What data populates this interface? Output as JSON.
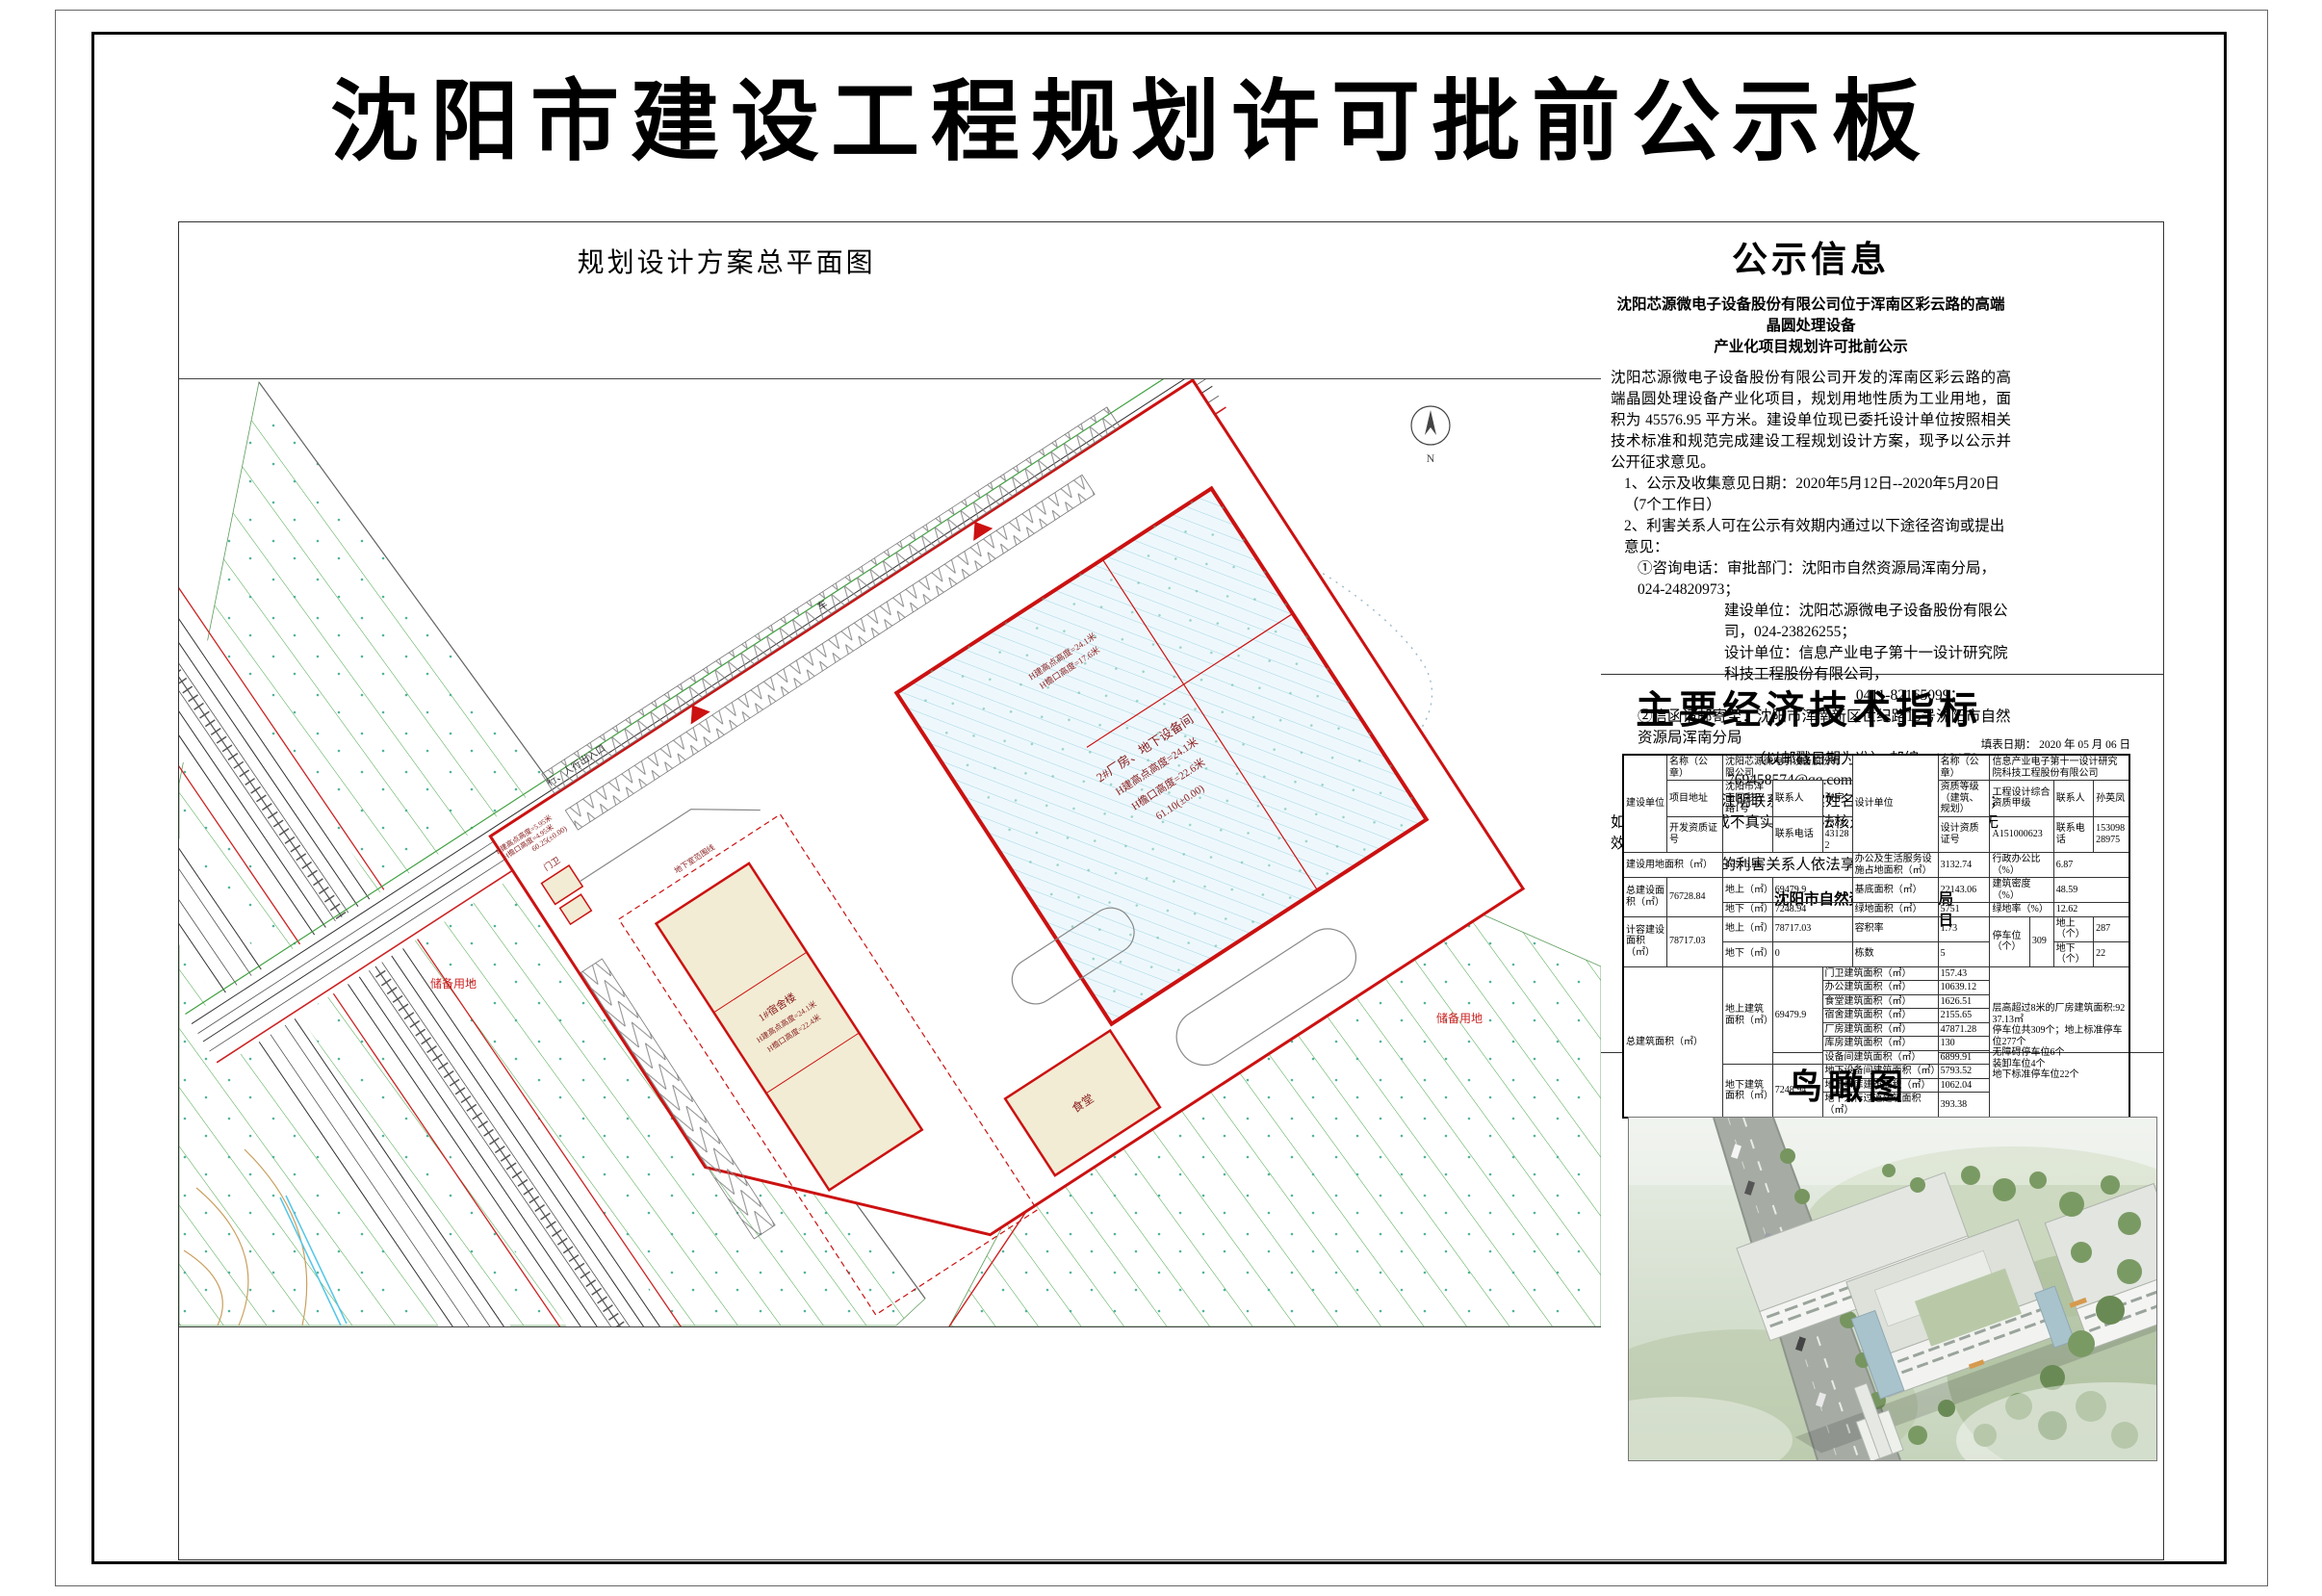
{
  "page": {
    "title": "沈阳市建设工程规划许可批前公示板"
  },
  "plan": {
    "title": "规划设计方案总平面图",
    "labels": {
      "reserve1": "储备用地",
      "reserve2": "储备用地",
      "factory_name": "2#厂房、地下设备间",
      "factory_h1": "H建高点高度=24.1米",
      "factory_h2": "H檐口高度=22.6米",
      "factory_elev": "61.10(±0.00)",
      "factory_h3": "H建高点高度=24.1米",
      "factory_h4": "H檐口高度=17.6米",
      "dorm_name": "1#宿舍楼",
      "dorm_h1": "H建高点高度=24.1米",
      "dorm_h2": "H檐口高度=22.4米",
      "canteen": "食堂",
      "gate": "门卫",
      "entrance": "车行、人行出入口",
      "basement": "地下室范围线",
      "gate_h1": "H建高点高度=5.95米",
      "gate_h2": "H檐口高度=4.95米",
      "gate_elev": "60.25(±0.00)",
      "north": "N"
    }
  },
  "notice": {
    "title": "公示信息",
    "subtitle": "沈阳芯源微电子设备股份有限公司位于浑南区彩云路的高端晶圆处理设备\n产业化项目规划许可批前公示",
    "para": "沈阳芯源微电子设备股份有限公司开发的浑南区彩云路的高端晶圆处理设备产业化项目，规划用地性质为工业用地，面积为 45576.95 平方米。建设单位现已委托设计单位按照相关技术标准和规范完成建设工程规划设计方案，现予以公示并公开征求意见。",
    "lines": [
      "1、公示及收集意见日期：2020年5月12日--2020年5月20日（7个工作日）",
      "2、利害关系人可在公示有效期内通过以下途径咨询或提出意见：",
      "①咨询电话：审批部门：沈阳市自然资源局浑南分局，024-24820973；",
      "建设单位：沈阳芯源微电子设备股份有限公司，024-23826255；",
      "设计单位：信息产业电子第十一设计研究院科技工程股份有限公司，",
      "0411-82165099；",
      "②信函请邮寄至：沈阳市浑南新区世纪路15号沈阳市自然资源局浑南分局",
      "（以邮戳日期为准）  邮编：110179。",
      "③电子邮箱：769458574@qq.com 。",
      "3、反馈意见请注明联系人真实姓名、电话、地址等信息；如因信息不完整或不真实导致无法核对相关情况的，视为无效意见。",
      "4、本方案涉及的利害关系人依法享有听证权。"
    ],
    "sign1": "沈阳市自然资源局浑南分局",
    "sign2": "2020年5月12日"
  },
  "indicators": {
    "title": "主要经济技术指标",
    "fill_date": "填表日期：  2020 年 05 月 06 日",
    "owner_group": "建设单位",
    "owner_name_label": "名称（公章）",
    "owner_name": "沈阳芯源微电子设备股份有限公司",
    "owner_addr_label": "项目地址",
    "owner_addr": "沈阳市浑南区彩云路1号",
    "owner_contact_label": "联系人",
    "owner_contact": "张宇",
    "owner_cert_label": "开发资质证号",
    "owner_cert": "",
    "owner_phone_label": "联系电话",
    "owner_phone": "13332431282",
    "designer_group": "设计单位",
    "designer_name_label": "名称（公章）",
    "designer_name": "信息产业电子第十一设计研究院科技工程股份有限公司",
    "designer_grade_label": "资质等级（建筑、规划）",
    "designer_grade": "工程设计综合资质甲级",
    "designer_contact_label": "联系人",
    "designer_contact": "孙英凤",
    "designer_cert_label": "设计资质证号",
    "designer_cert": "A151000623",
    "designer_phone_label": "联系电话",
    "designer_phone": "15309828975",
    "land_label": "建设用地面积（㎡）",
    "land": "45576.95",
    "office_land_label": "办公及生活服务设施占地面积（㎡）",
    "office_land": "3132.74",
    "admin_ratio_label": "行政办公比（%）",
    "admin_ratio": "6.87",
    "total_label": "总建设面积（㎡）",
    "total": "76728.84",
    "above_label": "地上（㎡）",
    "above": "69479.9",
    "below_label": "地下（㎡）",
    "below": "7248.94",
    "base_label": "基底面积（㎡）",
    "base": "22143.06",
    "density_label": "建筑密度（%）",
    "density": "48.59",
    "green_label": "绿地面积（㎡）",
    "green": "5751",
    "green_rate_label": "绿地率（%）",
    "green_rate": "12.62",
    "cap_label": "计容建设面积（㎡）",
    "cap": "78717.03",
    "cap_above_label": "地上（㎡）",
    "cap_above": "78717.03",
    "cap_below_label": "地下（㎡）",
    "cap_below": "0",
    "far_label": "容积率",
    "far": "1.73",
    "blocks_label": "栋数",
    "blocks": "5",
    "park_label": "停车位（个）",
    "park": "309",
    "park_above_label": "地上（个）",
    "park_above": "287",
    "park_below_label": "地下（个）",
    "park_below": "22",
    "gfa_label": "总建筑面积（㎡）",
    "gfa_above_label": "地上建筑面积（㎡）",
    "gfa_above": "69479.9",
    "gfa_below_label": "地下建筑面积（㎡）",
    "gfa_below": "7248.94",
    "items": [
      {
        "label": "门卫建筑面积（㎡）",
        "value": "157.43"
      },
      {
        "label": "办公建筑面积（㎡）",
        "value": "10639.12"
      },
      {
        "label": "食堂建筑面积（㎡）",
        "value": "1626.51"
      },
      {
        "label": "宿舍建筑面积（㎡）",
        "value": "2155.65"
      },
      {
        "label": "厂房建筑面积（㎡）",
        "value": "47871.28"
      },
      {
        "label": "库房建筑面积（㎡）",
        "value": "130"
      },
      {
        "label": "设备间建筑面积（㎡）",
        "value": "6899.91"
      }
    ],
    "below_items": [
      {
        "label": "地下设备间建筑面积（㎡）",
        "value": "5793.52"
      },
      {
        "label": "地下车库建筑面积（㎡）",
        "value": "1062.04"
      },
      {
        "label": "地下人行过道建筑面积（㎡）",
        "value": "393.38"
      }
    ],
    "note": "层高超过8米的厂房建筑面积:9237.13㎡\n停车位共309个；地上标准停车位277个\n无障碍停车位6个\n装卸车位4个\n地下标准停车位22个"
  },
  "birdseye": {
    "title": "鸟瞰图"
  }
}
